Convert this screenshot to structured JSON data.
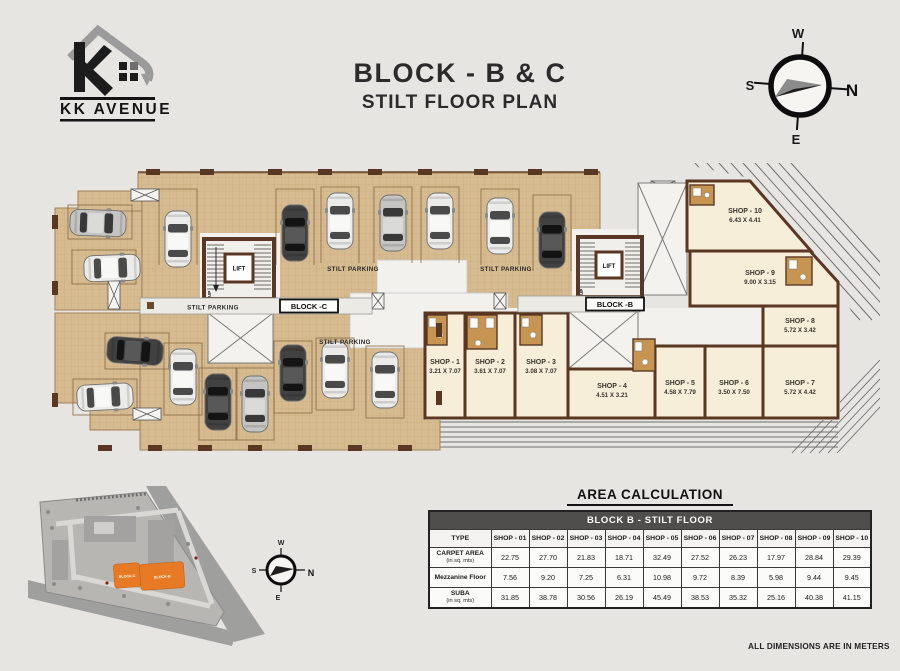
{
  "header": {
    "logo_text": "KK AVENUE",
    "title_line1": "BLOCK -  B & C",
    "title_line2": "STILT FLOOR PLAN"
  },
  "compass": {
    "n": "N",
    "s": "S",
    "e": "E",
    "w": "W"
  },
  "plan": {
    "lift_label": "LIFT",
    "up_label": "UP",
    "stilt_parking_label": "STILT PARKING",
    "block_c_label": "BLOCK -C",
    "block_b_label": "BLOCK -B",
    "shops": [
      {
        "name": "SHOP - 1",
        "dim": "3.21 X 7.07"
      },
      {
        "name": "SHOP - 2",
        "dim": "3.61 X 7.07"
      },
      {
        "name": "SHOP - 3",
        "dim": "3.08 X 7.07"
      },
      {
        "name": "SHOP - 4",
        "dim": "4.51 X 3.21"
      },
      {
        "name": "SHOP - 5",
        "dim": "4.58 X 7.79"
      },
      {
        "name": "SHOP - 6",
        "dim": "3.50 X 7.50"
      },
      {
        "name": "SHOP - 7",
        "dim": "5.72 X 4.42"
      },
      {
        "name": "SHOP - 8",
        "dim": "5.72 X 3.42"
      },
      {
        "name": "SHOP - 9",
        "dim": "9.00 X 3.15"
      },
      {
        "name": "SHOP - 10",
        "dim": "6.43 X 4.41"
      }
    ]
  },
  "site_plan": {
    "block_c": "BLOCK-C",
    "block_b": "BLOCK-B",
    "compass": {
      "n": "N",
      "s": "S",
      "e": "E",
      "w": "W"
    }
  },
  "area_table": {
    "title": "AREA CALCULATION",
    "subtitle": "BLOCK B - STILT FLOOR",
    "type_header": "TYPE",
    "shop_headers": [
      "SHOP - 01",
      "SHOP - 02",
      "SHOP - 03",
      "SHOP - 04",
      "SHOP - 05",
      "SHOP - 06",
      "SHOP - 07",
      "SHOP - 08",
      "SHOP - 09",
      "SHOP - 10"
    ],
    "rows": [
      {
        "label": "CARPET AREA",
        "sublabel": "(in sq. mts)",
        "values": [
          "22.75",
          "27.70",
          "21.83",
          "18.71",
          "32.49",
          "27.52",
          "26.23",
          "17.97",
          "28.84",
          "29.39"
        ]
      },
      {
        "label": "Mezzanine Floor",
        "sublabel": "",
        "values": [
          "7.56",
          "9.20",
          "7.25",
          "6.31",
          "10.98",
          "9.72",
          "8.39",
          "5.98",
          "9.44",
          "9.45"
        ]
      },
      {
        "label": "SUBA",
        "sublabel": "(in sq. mts)",
        "values": [
          "31.85",
          "38.78",
          "30.56",
          "26.19",
          "45.49",
          "38.53",
          "35.32",
          "25.16",
          "40.38",
          "41.15"
        ]
      }
    ]
  },
  "footer_note": "ALL DIMENSIONS ARE IN METERS",
  "colors": {
    "accent_orange": "#e87a25",
    "wall_brown": "#5a3722",
    "floor_tan": "#d6bb90",
    "shop_cream": "#f7eeda",
    "table_header_bg": "#4f4e4c"
  }
}
